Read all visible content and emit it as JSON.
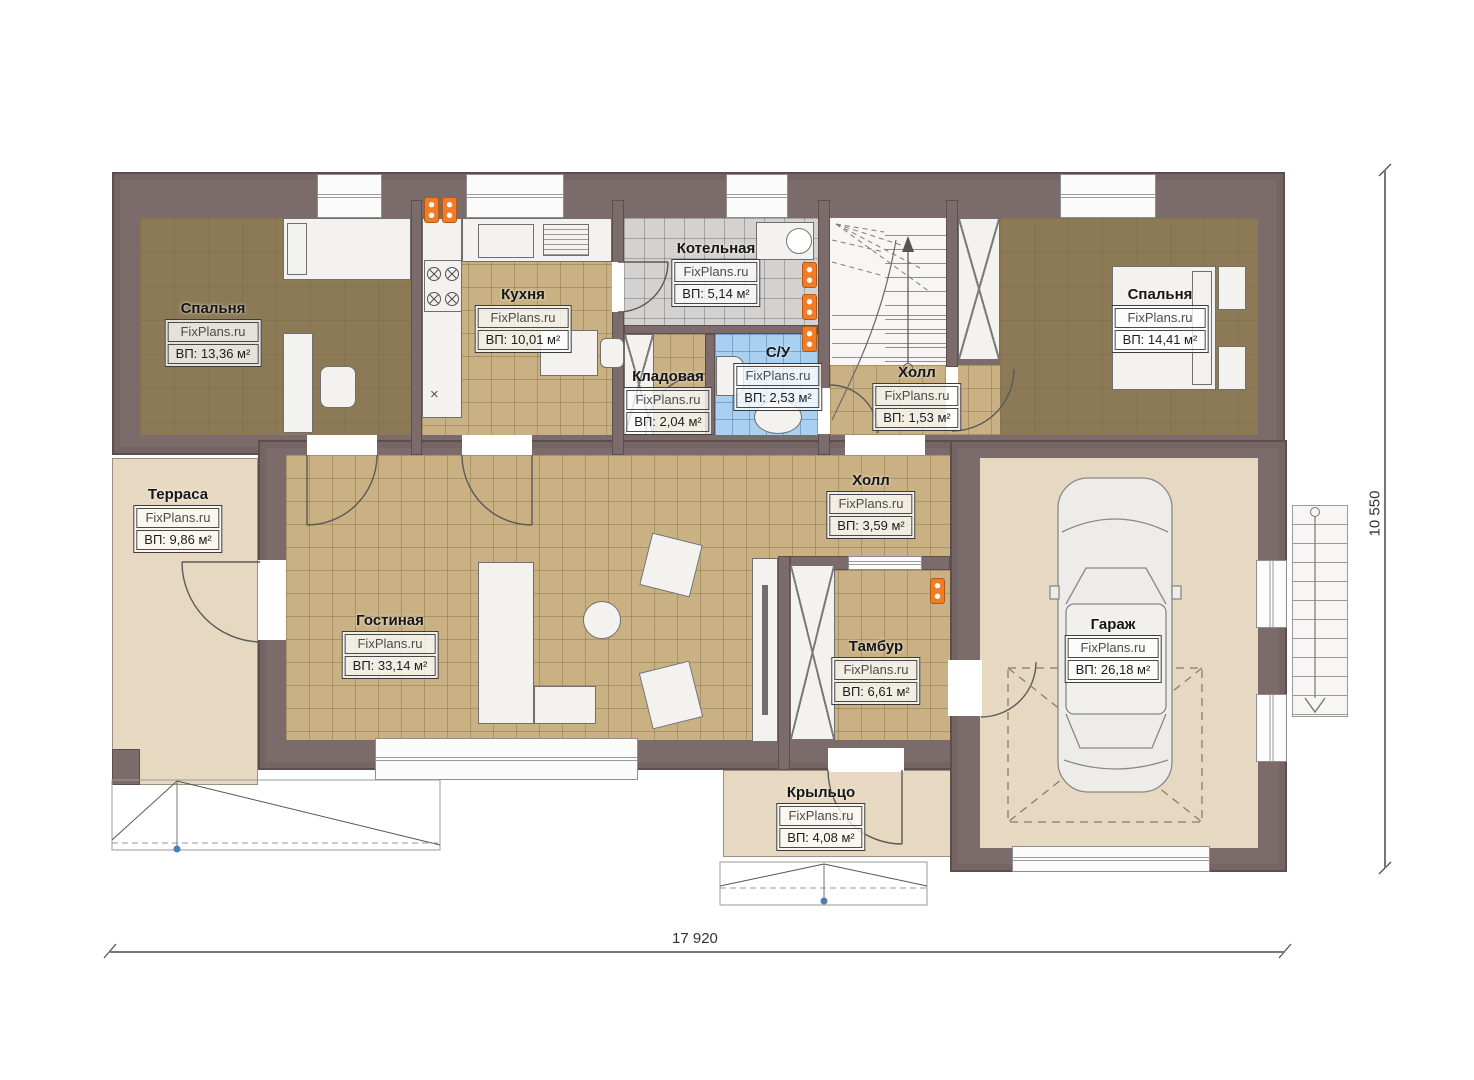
{
  "plan": {
    "site": "FixPlans.ru",
    "rooms": [
      {
        "key": "bedroom_left",
        "name": "Спальня",
        "area": "ВП: 13,36 м²"
      },
      {
        "key": "kitchen",
        "name": "Кухня",
        "area": "ВП: 10,01 м²"
      },
      {
        "key": "boiler",
        "name": "Котельная",
        "area": "ВП: 5,14 м²"
      },
      {
        "key": "pantry",
        "name": "Кладовая",
        "area": "ВП: 2,04 м²"
      },
      {
        "key": "bathroom",
        "name": "С/У",
        "area": "ВП: 2,53 м²"
      },
      {
        "key": "hall_small",
        "name": "Холл",
        "area": "ВП: 1,53 м²"
      },
      {
        "key": "bedroom_right",
        "name": "Спальня",
        "area": "ВП: 14,41 м²"
      },
      {
        "key": "terrace",
        "name": "Терраса",
        "area": "ВП: 9,86 м²"
      },
      {
        "key": "living",
        "name": "Гостиная",
        "area": "ВП: 33,14 м²"
      },
      {
        "key": "hall",
        "name": "Холл",
        "area": "ВП: 3,59 м²"
      },
      {
        "key": "vestibule",
        "name": "Тамбур",
        "area": "ВП: 6,61 м²"
      },
      {
        "key": "garage",
        "name": "Гараж",
        "area": "ВП: 26,18 м²"
      },
      {
        "key": "porch",
        "name": "Крыльцо",
        "area": "ВП: 4,08 м²"
      }
    ],
    "dimensions": {
      "width_mm": "17 920",
      "height_mm": "10 550"
    },
    "misc": {
      "kitchen_x": "×"
    },
    "palette": {
      "wall": "#7c6b6b",
      "floor_dark": "#8c7a56",
      "floor_tile_tan": "#c9b183",
      "floor_tile_gray": "#d3d2d0",
      "floor_tile_blue": "#a9d0f1",
      "floor_beige": "#e7d9c1",
      "radiator_orange": "#f07c28",
      "marker_blue": "#4a7fb5"
    }
  }
}
